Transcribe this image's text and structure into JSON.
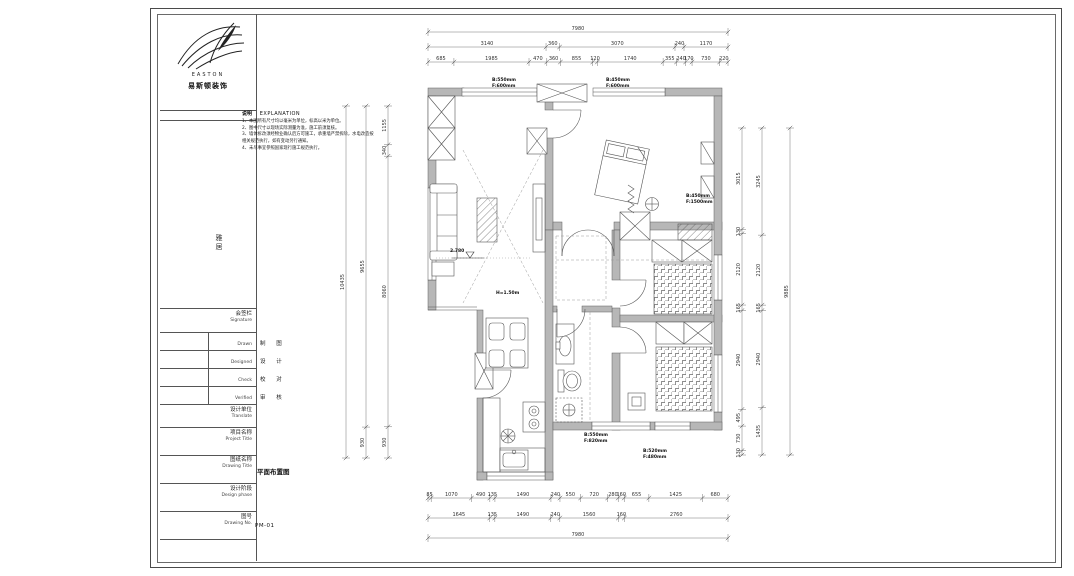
{
  "title_block": {
    "brand": {
      "name_en": "EASTON",
      "name_cn": "易斯顿装饰"
    },
    "project_vertical": "雅居",
    "signature": {
      "cn": "会签栏",
      "en": "Signature",
      "rows": [
        {
          "en": "Drawn",
          "cn": "制 图"
        },
        {
          "en": "Designed",
          "cn": "设 计"
        },
        {
          "en": "Check",
          "cn": "校 对"
        },
        {
          "en": "Verified",
          "cn": "审 核"
        }
      ]
    },
    "company": {
      "cn": "设计单位",
      "en": "Translate"
    },
    "project_title": {
      "cn": "项目名称",
      "en": "Project Title"
    },
    "drawing_title": {
      "cn": "图纸名称",
      "en": "Drawing Title",
      "value": "平面布置图"
    },
    "design_phase": {
      "cn": "设计阶段",
      "en": "Design phase"
    },
    "drawing_no": {
      "cn": "图号",
      "en": "Drawing No.",
      "value": "PM-01"
    }
  },
  "explanation": {
    "label_cn": "说明",
    "label_en": "EXPLANATION",
    "notes": [
      "1、本图所有尺寸均以毫米为单位，标高以米为单位。",
      "2、图中尺寸以现场实际测量为准，施工前须复核。",
      "3、墙体拆改须经物业确认后方可施工，承重墙严禁拆除，水电改造按相关规范执行，如有变动另行通知。",
      "4、未尽事宜参照国家现行施工规范执行。"
    ]
  },
  "dimensions": {
    "top": [
      [
        "7980"
      ],
      [
        "3140",
        "360",
        "3070",
        "240",
        "1170"
      ],
      [
        "685",
        "1985",
        "470",
        "360",
        "855",
        "120",
        "1740",
        "355",
        "240",
        "170",
        "730",
        "220"
      ]
    ],
    "bottom": [
      [
        "85",
        "1070",
        "490",
        "135",
        "1490",
        "240",
        "550",
        "720",
        "280",
        "160",
        "655",
        "1425",
        "680"
      ],
      [
        "1645",
        "135",
        "1490",
        "240",
        "1560",
        "160",
        "2760"
      ],
      [
        "7980"
      ]
    ],
    "left": [
      [
        "10435"
      ],
      [
        "9655",
        "930"
      ],
      [
        "1155",
        "340",
        "8060",
        "930"
      ]
    ],
    "right": [
      [
        "3015",
        "130",
        "2120",
        "165",
        "2940",
        "495",
        "730",
        "130"
      ],
      [
        "3245",
        "2120",
        "165",
        "2940",
        "1435"
      ],
      [
        "9885"
      ]
    ]
  },
  "annotations": {
    "level": "2.780",
    "height_note": "H=1.50m",
    "win_top_left": {
      "b": "B:550mm",
      "f": "F:600mm"
    },
    "win_top_right": {
      "b": "B:450mm",
      "f": "F:600mm"
    },
    "win_right": {
      "b": "B:450mm",
      "f": "F:1500mm"
    },
    "win_bottom_1": {
      "b": "B:550mm",
      "f": "F:820mm"
    },
    "win_bottom_2": {
      "b": "B:520mm",
      "f": "F:480mm"
    }
  }
}
